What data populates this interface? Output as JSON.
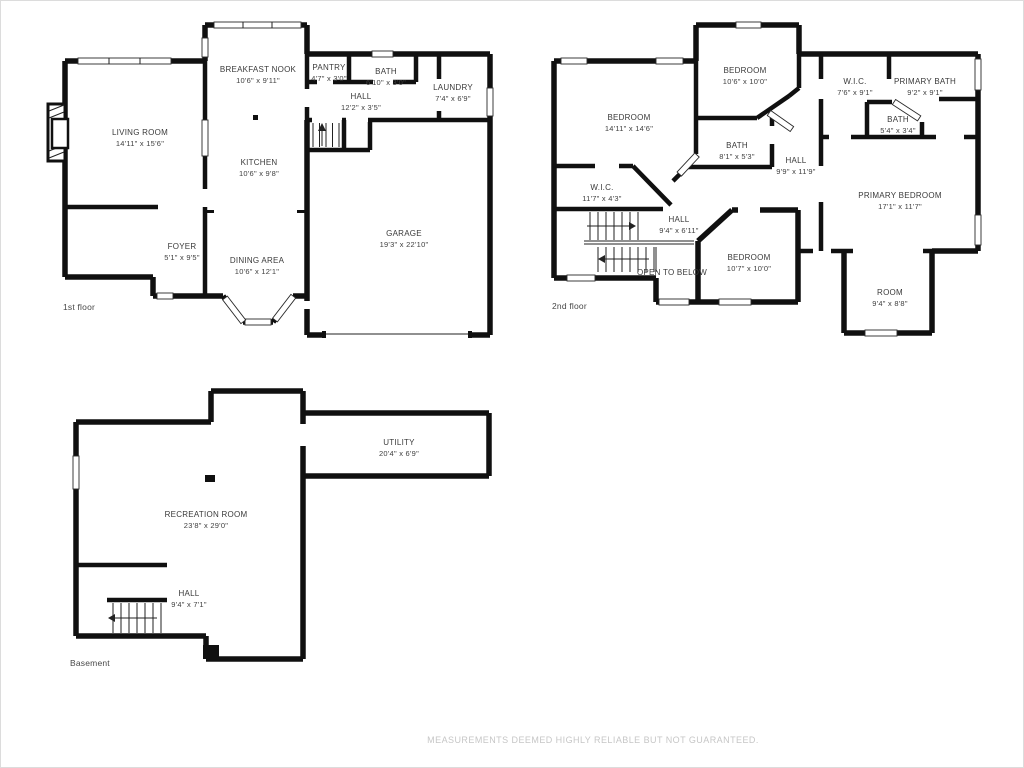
{
  "meta": {
    "colors": {
      "wall": "#101010",
      "label_text": "#3a3a3a",
      "disclaimer_text": "#c6c6c6"
    }
  },
  "footer": {
    "disclaimer": "MEASUREMENTS DEEMED HIGHLY RELIABLE BUT NOT GUARANTEED."
  },
  "floors": [
    {
      "id": "first-floor",
      "label": "1st floor",
      "label_pos": {
        "x": 62,
        "y": 301
      },
      "rooms": [
        {
          "name": "LIVING ROOM",
          "dims": "14'11\" x 15'6\"",
          "x": 139,
          "y": 127
        },
        {
          "name": "BREAKFAST NOOK",
          "dims": "10'6\" x 9'11\"",
          "x": 257,
          "y": 64
        },
        {
          "name": "PANTRY",
          "dims": "4'7\" x 3'0\"",
          "x": 328,
          "y": 62
        },
        {
          "name": "BATH",
          "dims": "6'10\" x 3'0\"",
          "x": 385,
          "y": 66
        },
        {
          "name": "LAUNDRY",
          "dims": "7'4\" x 6'9\"",
          "x": 452,
          "y": 82
        },
        {
          "name": "HALL",
          "dims": "12'2\" x 3'5\"",
          "x": 360,
          "y": 91
        },
        {
          "name": "KITCHEN",
          "dims": "10'6\" x 9'8\"",
          "x": 258,
          "y": 157
        },
        {
          "name": "GARAGE",
          "dims": "19'3\" x 22'10\"",
          "x": 403,
          "y": 228
        },
        {
          "name": "FOYER",
          "dims": "5'1\" x 9'5\"",
          "x": 181,
          "y": 241
        },
        {
          "name": "DINING AREA",
          "dims": "10'6\" x 12'1\"",
          "x": 256,
          "y": 255
        }
      ]
    },
    {
      "id": "second-floor",
      "label": "2nd floor",
      "label_pos": {
        "x": 551,
        "y": 300
      },
      "rooms": [
        {
          "name": "BEDROOM",
          "dims": "10'6\" x 10'0\"",
          "x": 744,
          "y": 65
        },
        {
          "name": "W.I.C.",
          "dims": "7'6\" x 9'1\"",
          "x": 854,
          "y": 76
        },
        {
          "name": "PRIMARY BATH",
          "dims": "9'2\" x 9'1\"",
          "x": 924,
          "y": 76
        },
        {
          "name": "BEDROOM",
          "dims": "14'11\" x 14'6\"",
          "x": 628,
          "y": 112
        },
        {
          "name": "BATH",
          "dims": "5'4\" x 3'4\"",
          "x": 897,
          "y": 114
        },
        {
          "name": "BATH",
          "dims": "8'1\" x 5'3\"",
          "x": 736,
          "y": 140
        },
        {
          "name": "HALL",
          "dims": "9'9\" x 11'9\"",
          "x": 795,
          "y": 155
        },
        {
          "name": "PRIMARY BEDROOM",
          "dims": "17'1\" x 11'7\"",
          "x": 899,
          "y": 190
        },
        {
          "name": "W.I.C.",
          "dims": "11'7\" x 4'3\"",
          "x": 601,
          "y": 182
        },
        {
          "name": "HALL",
          "dims": "9'4\" x 6'11\"",
          "x": 678,
          "y": 214
        },
        {
          "name": "OPEN TO BELOW",
          "dims": "",
          "x": 671,
          "y": 267
        },
        {
          "name": "BEDROOM",
          "dims": "10'7\" x 10'0\"",
          "x": 748,
          "y": 252
        },
        {
          "name": "ROOM",
          "dims": "9'4\" x 8'8\"",
          "x": 889,
          "y": 287
        }
      ]
    },
    {
      "id": "basement",
      "label": "Basement",
      "label_pos": {
        "x": 69,
        "y": 657
      },
      "rooms": [
        {
          "name": "UTILITY",
          "dims": "20'4\" x 6'9\"",
          "x": 398,
          "y": 437
        },
        {
          "name": "RECREATION ROOM",
          "dims": "23'8\" x 29'0\"",
          "x": 205,
          "y": 509
        },
        {
          "name": "HALL",
          "dims": "9'4\" x 7'1\"",
          "x": 188,
          "y": 588
        }
      ]
    }
  ]
}
